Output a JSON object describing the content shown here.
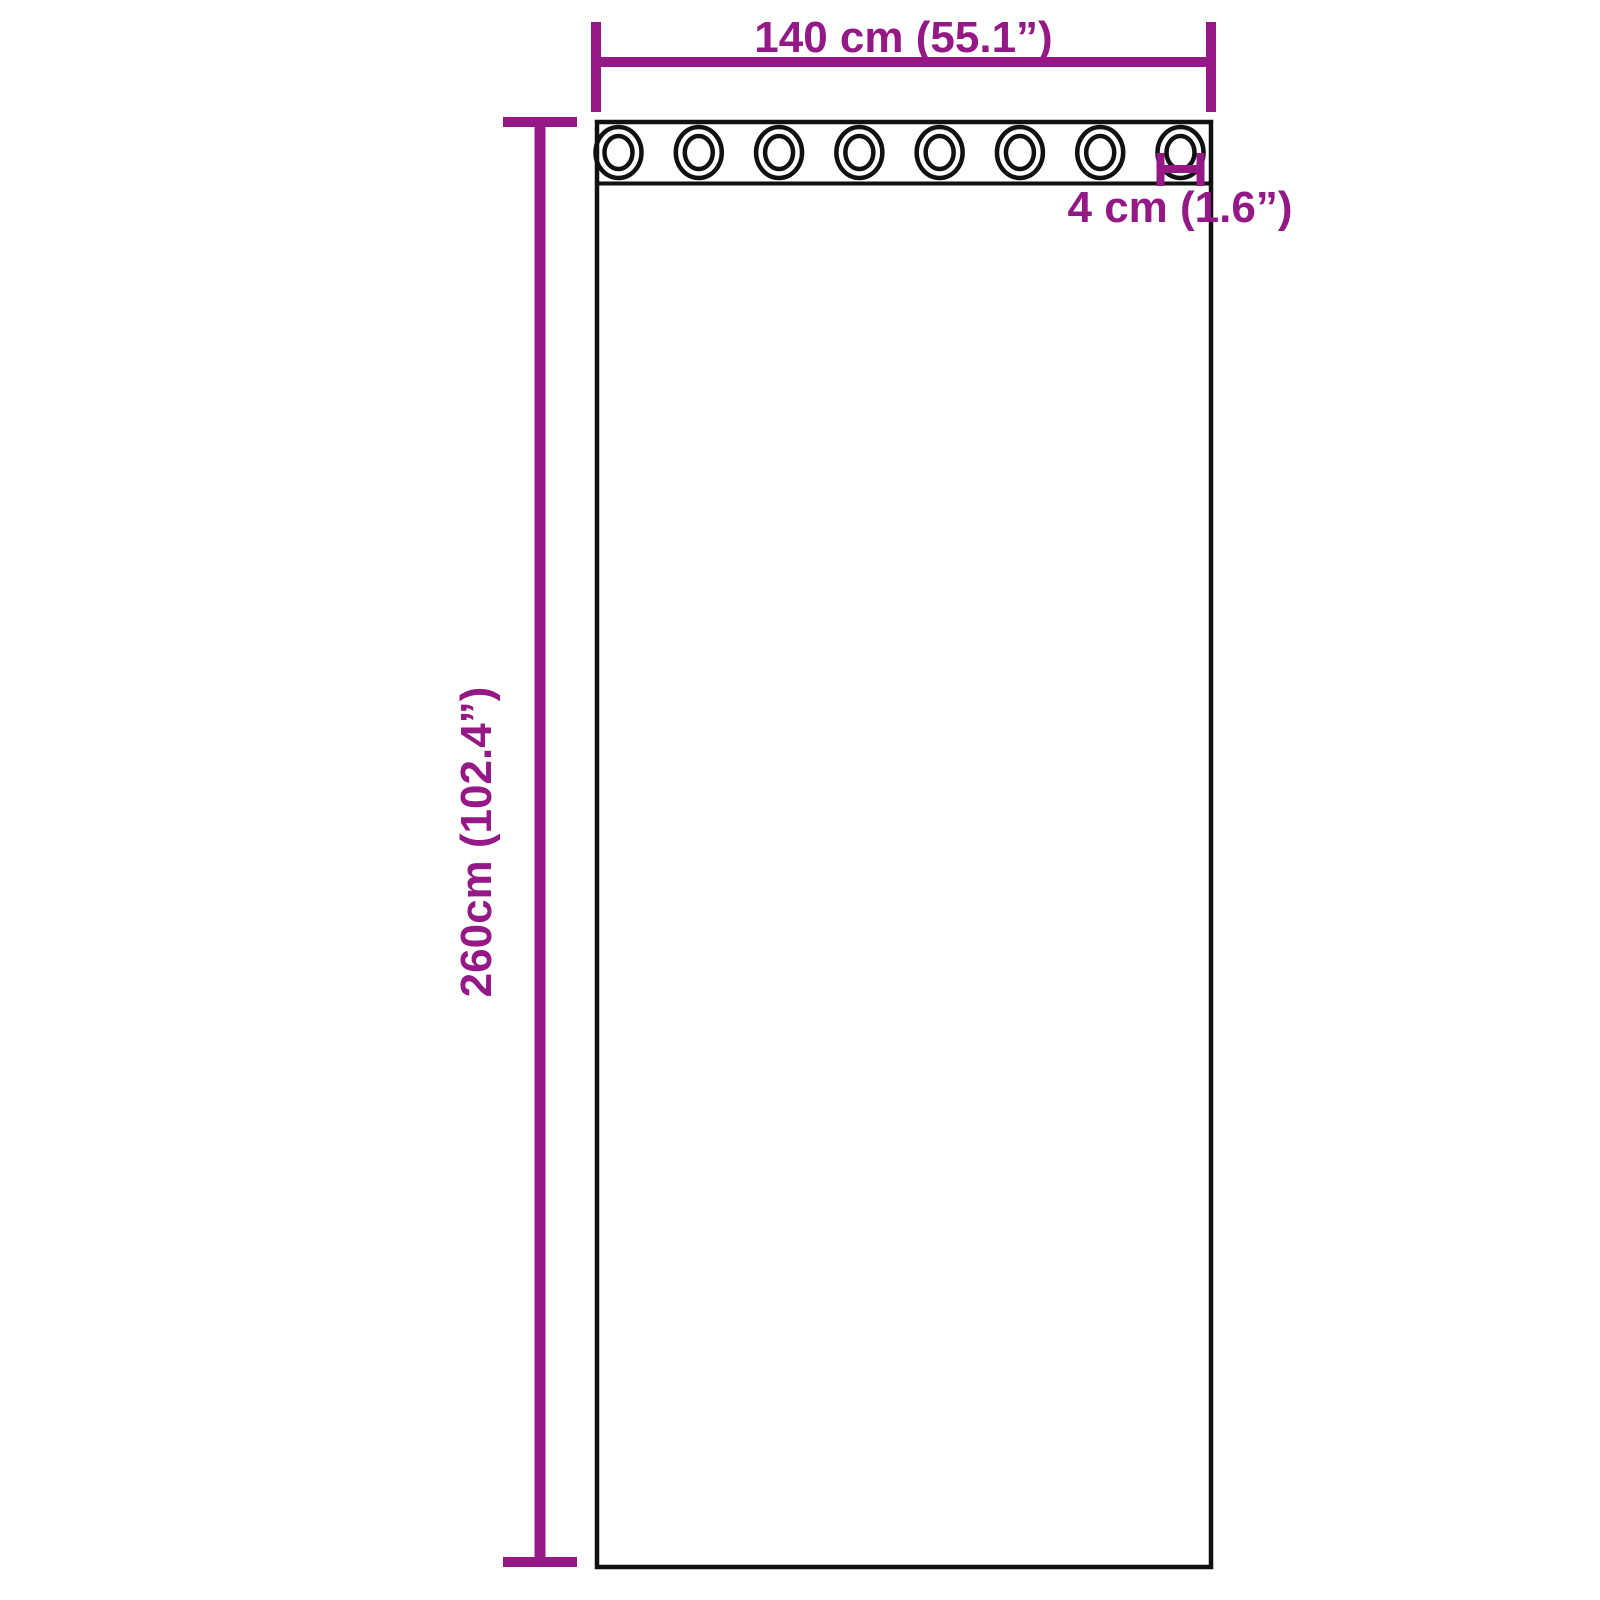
{
  "page": {
    "background": "#ffffff",
    "description": "Product dimension diagram of a grommet-top curtain panel"
  },
  "colors": {
    "dimension_accent": "#941886",
    "outline": "#111111"
  },
  "dimensions": {
    "width": {
      "label": "140 cm (55.1”)",
      "value_cm": 140,
      "value_inch": 55.1
    },
    "height": {
      "label": "260cm (102.4”)",
      "value_cm": 260,
      "value_inch": 102.4
    },
    "grommet": {
      "label": "4 cm (1.6”)",
      "value_cm": 4,
      "value_inch": 1.6
    }
  },
  "curtain": {
    "grommets": {
      "count": 8
    }
  }
}
